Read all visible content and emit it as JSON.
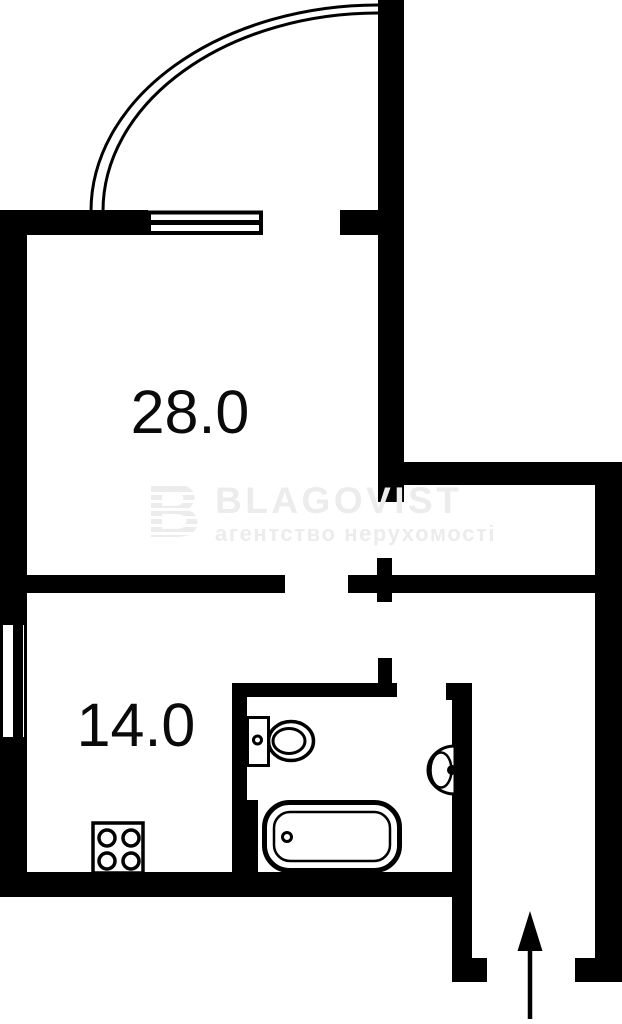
{
  "plan": {
    "title": "apartment floor plan",
    "rooms": [
      {
        "id": "living-room",
        "area": "28.0"
      },
      {
        "id": "kitchen",
        "area": "14.0"
      }
    ],
    "fixtures": [
      "entry-door-swing-arc",
      "window-top",
      "window-left",
      "toilet",
      "washbasin",
      "bathtub",
      "stove-4-burners",
      "entrance-direction-arrow"
    ],
    "colors": {
      "wall": "#000000",
      "background": "#ffffff",
      "watermark": "#ececec",
      "label": "#0a0a0a"
    },
    "watermark": {
      "brand": "BLAGOVIST",
      "tagline": "агентство нерухомості",
      "logo_letter": "B"
    }
  }
}
